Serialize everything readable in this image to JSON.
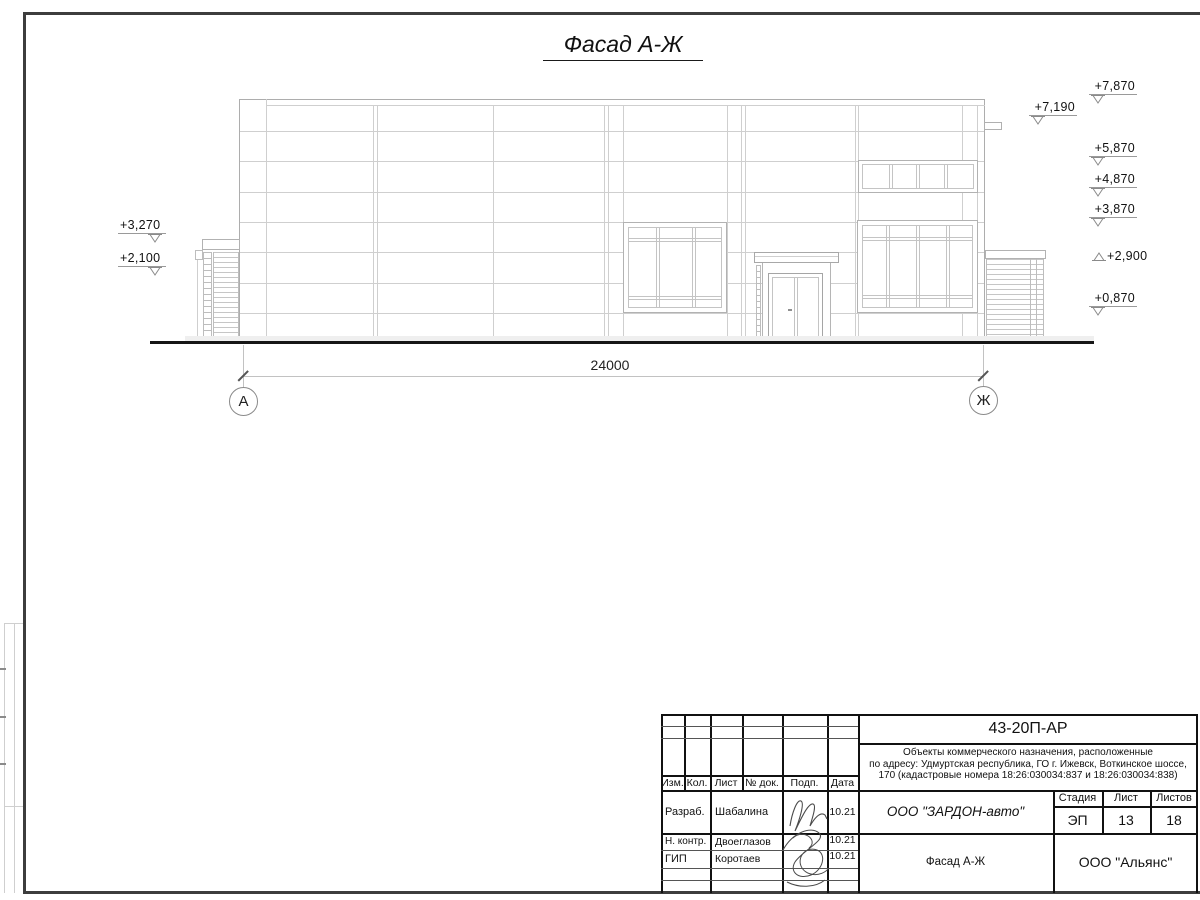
{
  "sheet": {
    "title": "Фасад А-Ж"
  },
  "drawing": {
    "dimension": "24000",
    "axis_left": "А",
    "axis_right": "Ж",
    "marks_left": [
      {
        "label": "+3,270"
      },
      {
        "label": "+2,100"
      }
    ],
    "marks_right": [
      {
        "label": "+7,870"
      },
      {
        "label": "+7,190"
      },
      {
        "label": "+5,870"
      },
      {
        "label": "+4,870"
      },
      {
        "label": "+3,870"
      },
      {
        "label": "+2,900"
      },
      {
        "label": "+0,870"
      }
    ]
  },
  "titleblock": {
    "doc_number": "43-20П-АР",
    "description_line1": "Объекты коммерческого назначения, расположенные",
    "description_line2": "по адресу: Удмуртская республика, ГО г. Ижевск, Воткинское шоссе,",
    "description_line3": "170 (кадастровые номера 18:26:030034:837 и 18:26:030034:838)",
    "col_izm": "Изм.",
    "col_kol": "Кол.",
    "col_list": "Лист",
    "col_dok": "№ док.",
    "col_podp": "Подп.",
    "col_data": "Дата",
    "row1_role": "Разраб.",
    "row1_name": "Шабалина",
    "row1_date": "10.21",
    "row2_role": "Н. контр.",
    "row2_name": "Двоеглазов",
    "row2_date": "10.21",
    "row3_role": "ГИП",
    "row3_name": "Коротаев",
    "row3_date": "10.21",
    "org": "ООО \"ЗАРДОН-авто\"",
    "stage_label": "Стадия",
    "sheet_label": "Лист",
    "sheets_label": "Листов",
    "stage_value": "ЭП",
    "sheet_value": "13",
    "sheets_value": "18",
    "sheet_title": "Фасад А-Ж",
    "company": "ООО \"Альянс\""
  }
}
